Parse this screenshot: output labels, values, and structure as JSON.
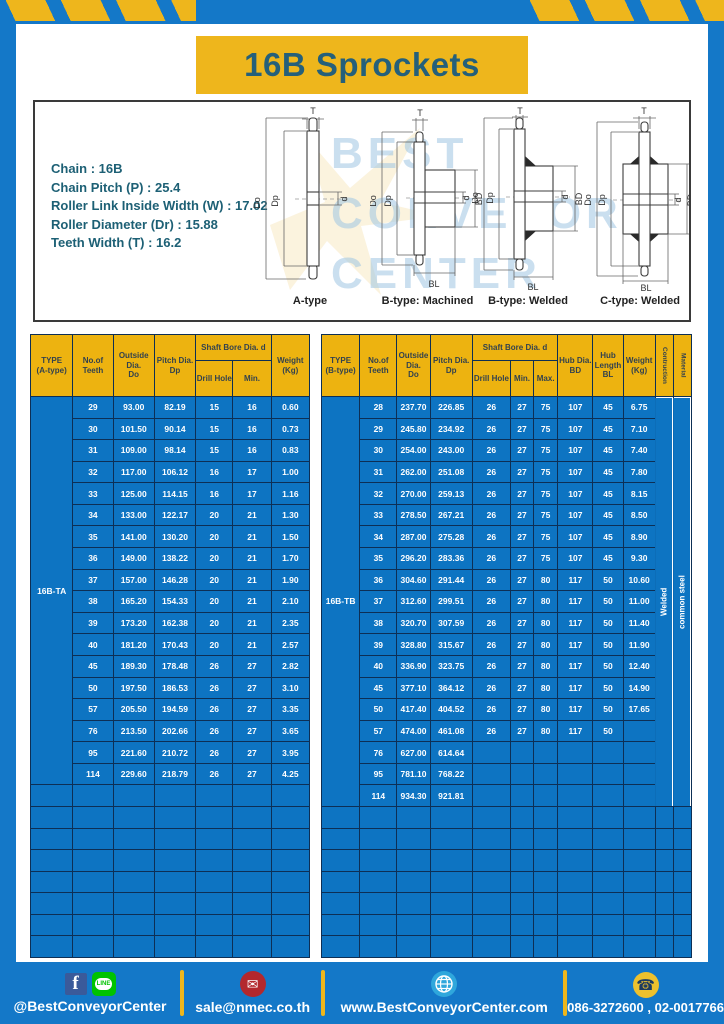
{
  "title": "16B Sprockets",
  "colors": {
    "frame_blue": "#1478c8",
    "accent_yellow": "#eeb61c",
    "header_yellow": "#edb310",
    "cell_blue": "#0d74c2",
    "border_navy": "#0d2f55",
    "title_teal": "#25607a",
    "spec_teal": "#1d6075",
    "fb_blue": "#3a5a9a",
    "line_green": "#00c300",
    "email_red": "#b3282d",
    "globe_blue": "#2fa7dc",
    "phone_yellow": "#eec12d"
  },
  "specs": {
    "lines": [
      "Chain : 16B",
      "Chain Pitch (P) : 25.4",
      "Roller Link Inside Width (W) : 17.02",
      "Roller Diameter (Dr) : 15.88",
      "Teeth Width (T) : 16.2"
    ]
  },
  "watermark": {
    "lines": [
      "BEST",
      "CONVEYOR",
      "CENTER"
    ]
  },
  "drawings": {
    "labels": [
      "A-type",
      "B-type: Machined",
      "B-type: Welded",
      "C-type: Welded"
    ],
    "dims": {
      "t": "T",
      "dia_outer": "Do",
      "dia_pitch": "Dp",
      "bore": "d",
      "hub_dia": "BD",
      "hub_len": "BL"
    }
  },
  "table_a": {
    "type_label": "16B-TA",
    "headers": {
      "type": [
        "TYPE",
        "(A-type)"
      ],
      "teeth": [
        "No.of",
        "Teeth"
      ],
      "outside": [
        "Outside",
        "Dia.",
        "Do"
      ],
      "pitch": [
        "Pitch Dia.",
        "Dp"
      ],
      "shaft_group": "Shaft Bore Dia. d",
      "drill": "Drill Hole",
      "min": "Min.",
      "weight": [
        "Weight",
        "(Kg)"
      ]
    },
    "rows": [
      [
        "29",
        "93.00",
        "82.19",
        "15",
        "16",
        "0.60"
      ],
      [
        "30",
        "101.50",
        "90.14",
        "15",
        "16",
        "0.73"
      ],
      [
        "31",
        "109.00",
        "98.14",
        "15",
        "16",
        "0.83"
      ],
      [
        "32",
        "117.00",
        "106.12",
        "16",
        "17",
        "1.00"
      ],
      [
        "33",
        "125.00",
        "114.15",
        "16",
        "17",
        "1.16"
      ],
      [
        "34",
        "133.00",
        "122.17",
        "20",
        "21",
        "1.30"
      ],
      [
        "35",
        "141.00",
        "130.20",
        "20",
        "21",
        "1.50"
      ],
      [
        "36",
        "149.00",
        "138.22",
        "20",
        "21",
        "1.70"
      ],
      [
        "37",
        "157.00",
        "146.28",
        "20",
        "21",
        "1.90"
      ],
      [
        "38",
        "165.20",
        "154.33",
        "20",
        "21",
        "2.10"
      ],
      [
        "39",
        "173.20",
        "162.38",
        "20",
        "21",
        "2.35"
      ],
      [
        "40",
        "181.20",
        "170.43",
        "20",
        "21",
        "2.57"
      ],
      [
        "45",
        "189.30",
        "178.48",
        "26",
        "27",
        "2.82"
      ],
      [
        "50",
        "197.50",
        "186.53",
        "26",
        "27",
        "3.10"
      ],
      [
        "57",
        "205.50",
        "194.59",
        "26",
        "27",
        "3.35"
      ],
      [
        "76",
        "213.50",
        "202.66",
        "26",
        "27",
        "3.65"
      ],
      [
        "95",
        "221.60",
        "210.72",
        "26",
        "27",
        "3.95"
      ],
      [
        "114",
        "229.60",
        "218.79",
        "26",
        "27",
        "4.25"
      ]
    ],
    "empty_rows": 8
  },
  "table_b": {
    "type_label": "16B-TB",
    "headers": {
      "type": [
        "TYPE",
        "(B-type)"
      ],
      "teeth": [
        "No.of",
        "Teeth"
      ],
      "outside": [
        "Outside",
        "Dia.",
        "Do"
      ],
      "pitch": [
        "Pitch Dia.",
        "Dp"
      ],
      "shaft_group": "Shaft Bore Dia. d",
      "drill": "Drill Hole",
      "min": "Min.",
      "max": "Max.",
      "hub_dia": [
        "Hub Dia.",
        "BD"
      ],
      "hub_length": [
        "Hub",
        "Length",
        "BL"
      ],
      "weight": [
        "Weight",
        "(Kg)"
      ],
      "construction": "Contruction",
      "material": "Material"
    },
    "construction_value": "Welded",
    "material_value": "common steel",
    "rows": [
      [
        "28",
        "237.70",
        "226.85",
        "26",
        "27",
        "75",
        "107",
        "45",
        "6.75"
      ],
      [
        "29",
        "245.80",
        "234.92",
        "26",
        "27",
        "75",
        "107",
        "45",
        "7.10"
      ],
      [
        "30",
        "254.00",
        "243.00",
        "26",
        "27",
        "75",
        "107",
        "45",
        "7.40"
      ],
      [
        "31",
        "262.00",
        "251.08",
        "26",
        "27",
        "75",
        "107",
        "45",
        "7.80"
      ],
      [
        "32",
        "270.00",
        "259.13",
        "26",
        "27",
        "75",
        "107",
        "45",
        "8.15"
      ],
      [
        "33",
        "278.50",
        "267.21",
        "26",
        "27",
        "75",
        "107",
        "45",
        "8.50"
      ],
      [
        "34",
        "287.00",
        "275.28",
        "26",
        "27",
        "75",
        "107",
        "45",
        "8.90"
      ],
      [
        "35",
        "296.20",
        "283.36",
        "26",
        "27",
        "75",
        "107",
        "45",
        "9.30"
      ],
      [
        "36",
        "304.60",
        "291.44",
        "26",
        "27",
        "80",
        "117",
        "50",
        "10.60"
      ],
      [
        "37",
        "312.60",
        "299.51",
        "26",
        "27",
        "80",
        "117",
        "50",
        "11.00"
      ],
      [
        "38",
        "320.70",
        "307.59",
        "26",
        "27",
        "80",
        "117",
        "50",
        "11.40"
      ],
      [
        "39",
        "328.80",
        "315.67",
        "26",
        "27",
        "80",
        "117",
        "50",
        "11.90"
      ],
      [
        "40",
        "336.90",
        "323.75",
        "26",
        "27",
        "80",
        "117",
        "50",
        "12.40"
      ],
      [
        "45",
        "377.10",
        "364.12",
        "26",
        "27",
        "80",
        "117",
        "50",
        "14.90"
      ],
      [
        "50",
        "417.40",
        "404.52",
        "26",
        "27",
        "80",
        "117",
        "50",
        "17.65"
      ],
      [
        "57",
        "474.00",
        "461.08",
        "26",
        "27",
        "80",
        "117",
        "50",
        ""
      ],
      [
        "76",
        "627.00",
        "614.64",
        "",
        "",
        "",
        "",
        "",
        ""
      ],
      [
        "95",
        "781.10",
        "768.22",
        "",
        "",
        "",
        "",
        "",
        ""
      ],
      [
        "114",
        "934.30",
        "921.81",
        "",
        "",
        "",
        "",
        "",
        ""
      ]
    ],
    "empty_rows": 7
  },
  "footer": {
    "social_handle": "@BestConveyorCenter",
    "line_label": "LINE",
    "facebook_label": "f",
    "email": "sale@nmec.co.th",
    "website": "www.BestConveyorCenter.com",
    "phones": "086-3272600 , 02-0017766",
    "mail_glyph": "✉",
    "phone_glyph": "☎"
  }
}
